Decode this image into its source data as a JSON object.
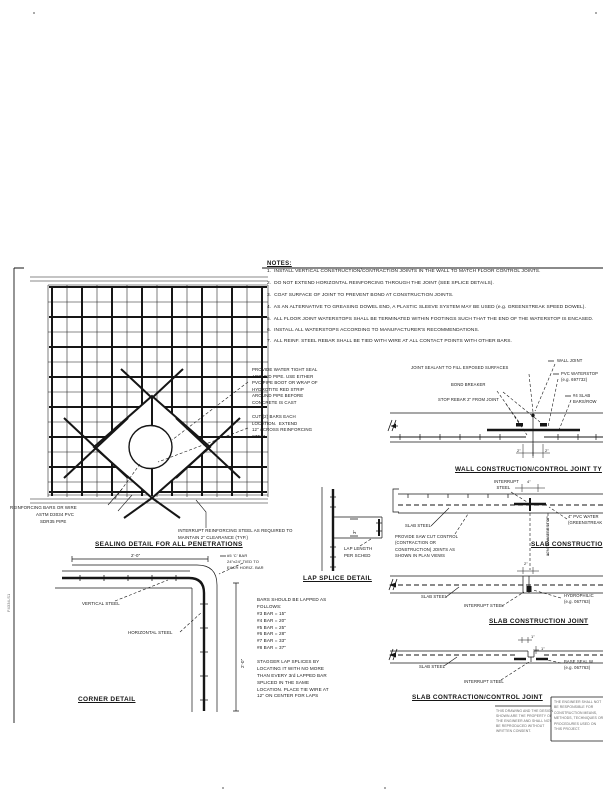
{
  "notes": {
    "title": "NOTES:",
    "items": [
      "1.  INSTALL VERTICAL CONSTRUCTION/CONTRACTION JOINTS IN THE WALL TO MATCH FLOOR CONTROL JOINTS.",
      "2.  DO NOT EXTEND HORIZONTAL REINFORCING THROUGH THE JOINT (SEE SPLICE DETAILS).",
      "3.  COAT SURFACE OF JOINT TO PREVENT BOND AT CONSTRUCTION JOINTS.",
      "4.  AS AN ALTERNATIVE TO GREASING DOWEL END, A PLASTIC SLEEVE SYSTEM MAY BE USED (e.g. GREENSTREAK SPEED DOWEL).",
      "5.  ALL FLOOR JOINT WATERSTOPS SHALL BE TERMINATED WITHIN FOOTINGS SUCH THAT THE END OF THE WATERSTOP IS ENCASED.",
      "6.  INSTALL ALL WATERSTOPS ACCORDING TO MANUFACTURER'S RECOMMENDATIONS.",
      "7.  ALL REINF. STEEL REBAR SHALL BE TIED WITH WIRE AT ALL CONTACT POINTS WITH OTHER BARS."
    ]
  },
  "sealing": {
    "title": "SEALING DETAIL FOR ALL PENETRATIONS",
    "pipe_seal_label": "PROVIDE WATER TIGHT SEAL\nAROUND PIPE. USE EITHER\nPVC PIPE BOOT OR WRAP OF\nHYDROTITE RED STRIP\nAROUND PIPE BEFORE\nCONCRETE IS CAST",
    "cut_bars_label": "CUT (2) BARS EACH\nLOCATION.  EXTEND\n12\" ACROSS REINFORCING\nSTEEL",
    "reinforcing_label": "REINFORCING BARS OR WIRE",
    "pipe_label_1": "ASTM D3034 PVC",
    "pipe_label_2": "SDR35 PIPE",
    "interrupt_label": "INTERRUPT REINFORCING STEEL AS REQUIRED TO\nMAINTAIN 2\" CLEARANCE (TYP.)"
  },
  "corner": {
    "title": "CORNER DETAIL",
    "dim_top": "2'-0\"",
    "dim_right": "2'-0\"",
    "vertical_steel": "VERTICAL STEEL",
    "horizontal_steel": "HORIZONTAL STEEL",
    "corner_bar_label": "#5 'C' BAR\n24\"x24\" TIED TO\nEACH HORIZ. BAR"
  },
  "lap": {
    "title": "LAP SPLICE DETAIL",
    "dim": "3\"",
    "length_label": "LAP LENGTH\nPER SCHED",
    "schedule": "BARS SHOULD BE LAPPED AS\nFOLLOWS:\n#3 BAR = 15\"\n#4 BAR = 20\"\n#5 BAR = 25\"\n#6 BAR = 28\"\n#7 BAR = 33\"\n#8 BAR = 37\"\n\nSTAGGER LAP SPLICES BY\nLOCATING IT WITH NO MORE\nTHAN EVERY 3rd LAPPED BAR\nSPLICED IN THE SAME\nLOCATION. PLACE TIE WIRE AT\n12\" ON CENTER FOR LAPS"
  },
  "wall_joint": {
    "title": "WALL CONSTRUCTION/CONTROL JOINT TY",
    "sealant_label": "JOINT SEALANT TO FILL EXPOSED SURFACES",
    "bond_breaker_label": "BOND BREAKER",
    "stop_rebar_label": "STOP REBAR 2\" FROM JOINT",
    "wall_joint_label": "WALL JOINT",
    "waterstop_label": "PVC WATERSTOP\n(e.g. 697732)",
    "slab_bars_label": "#4 SLAB\nBARS/ROW",
    "dim_left": "2\"",
    "dim_right": "2\""
  },
  "slab1": {
    "title": "SLAB CONSTRUCTIO",
    "dim": "4\"",
    "interrupt_label": "INTERRUPT\n  STEEL",
    "slab_steel_label": "SLAB STEEL",
    "provide_label": "PROVIDE SAW CUT CONTROL\n(CONTRACTION OR\nCONSTRUCTION) JOINTS AS\nSHOWN IN PLAN VIEWS",
    "waterstop_dim": "12\" TO WATERSTOP",
    "pvc_label": "4\" PVC WATER\n(GREENSTREAK"
  },
  "slab2": {
    "title": "SLAB CONSTRUCTION JOINT",
    "dim": "2\"",
    "slab_steel_label": "SLAB STEEL",
    "interrupt_label": "INTERRUPT STEEL",
    "hydrophilic_label": "HYDROPHILIC\n(e.g. 067763)"
  },
  "slab3": {
    "title": "SLAB CONTRACTION/CONTROL JOINT",
    "dim_width": "1\"",
    "dim_depth": "1\"",
    "slab_steel_label": "SLAB STEEL",
    "interrupt_label": "INTERRUPT STEEL",
    "base_seal_label": "BASE SEAL W\n(e.g. 067763)"
  },
  "stamp": {
    "disclaimer": "THIS DRAWING AND THE DESIGN\nSHOWN ARE THE PROPERTY OF\nTHE ENGINEER AND SHALL NOT\nBE REPRODUCED WITHOUT\nWRITTEN CONSENT.",
    "box_text": "THE ENGINEER SHALL NOT\nBE RESPONSIBLE FOR\nCONSTRUCTION MEANS,\nMETHODS, TECHNIQUES OR\nPROCEDURES USED ON\nTHIS PROJECT.",
    "plot_stamp": "F4334-S1"
  }
}
